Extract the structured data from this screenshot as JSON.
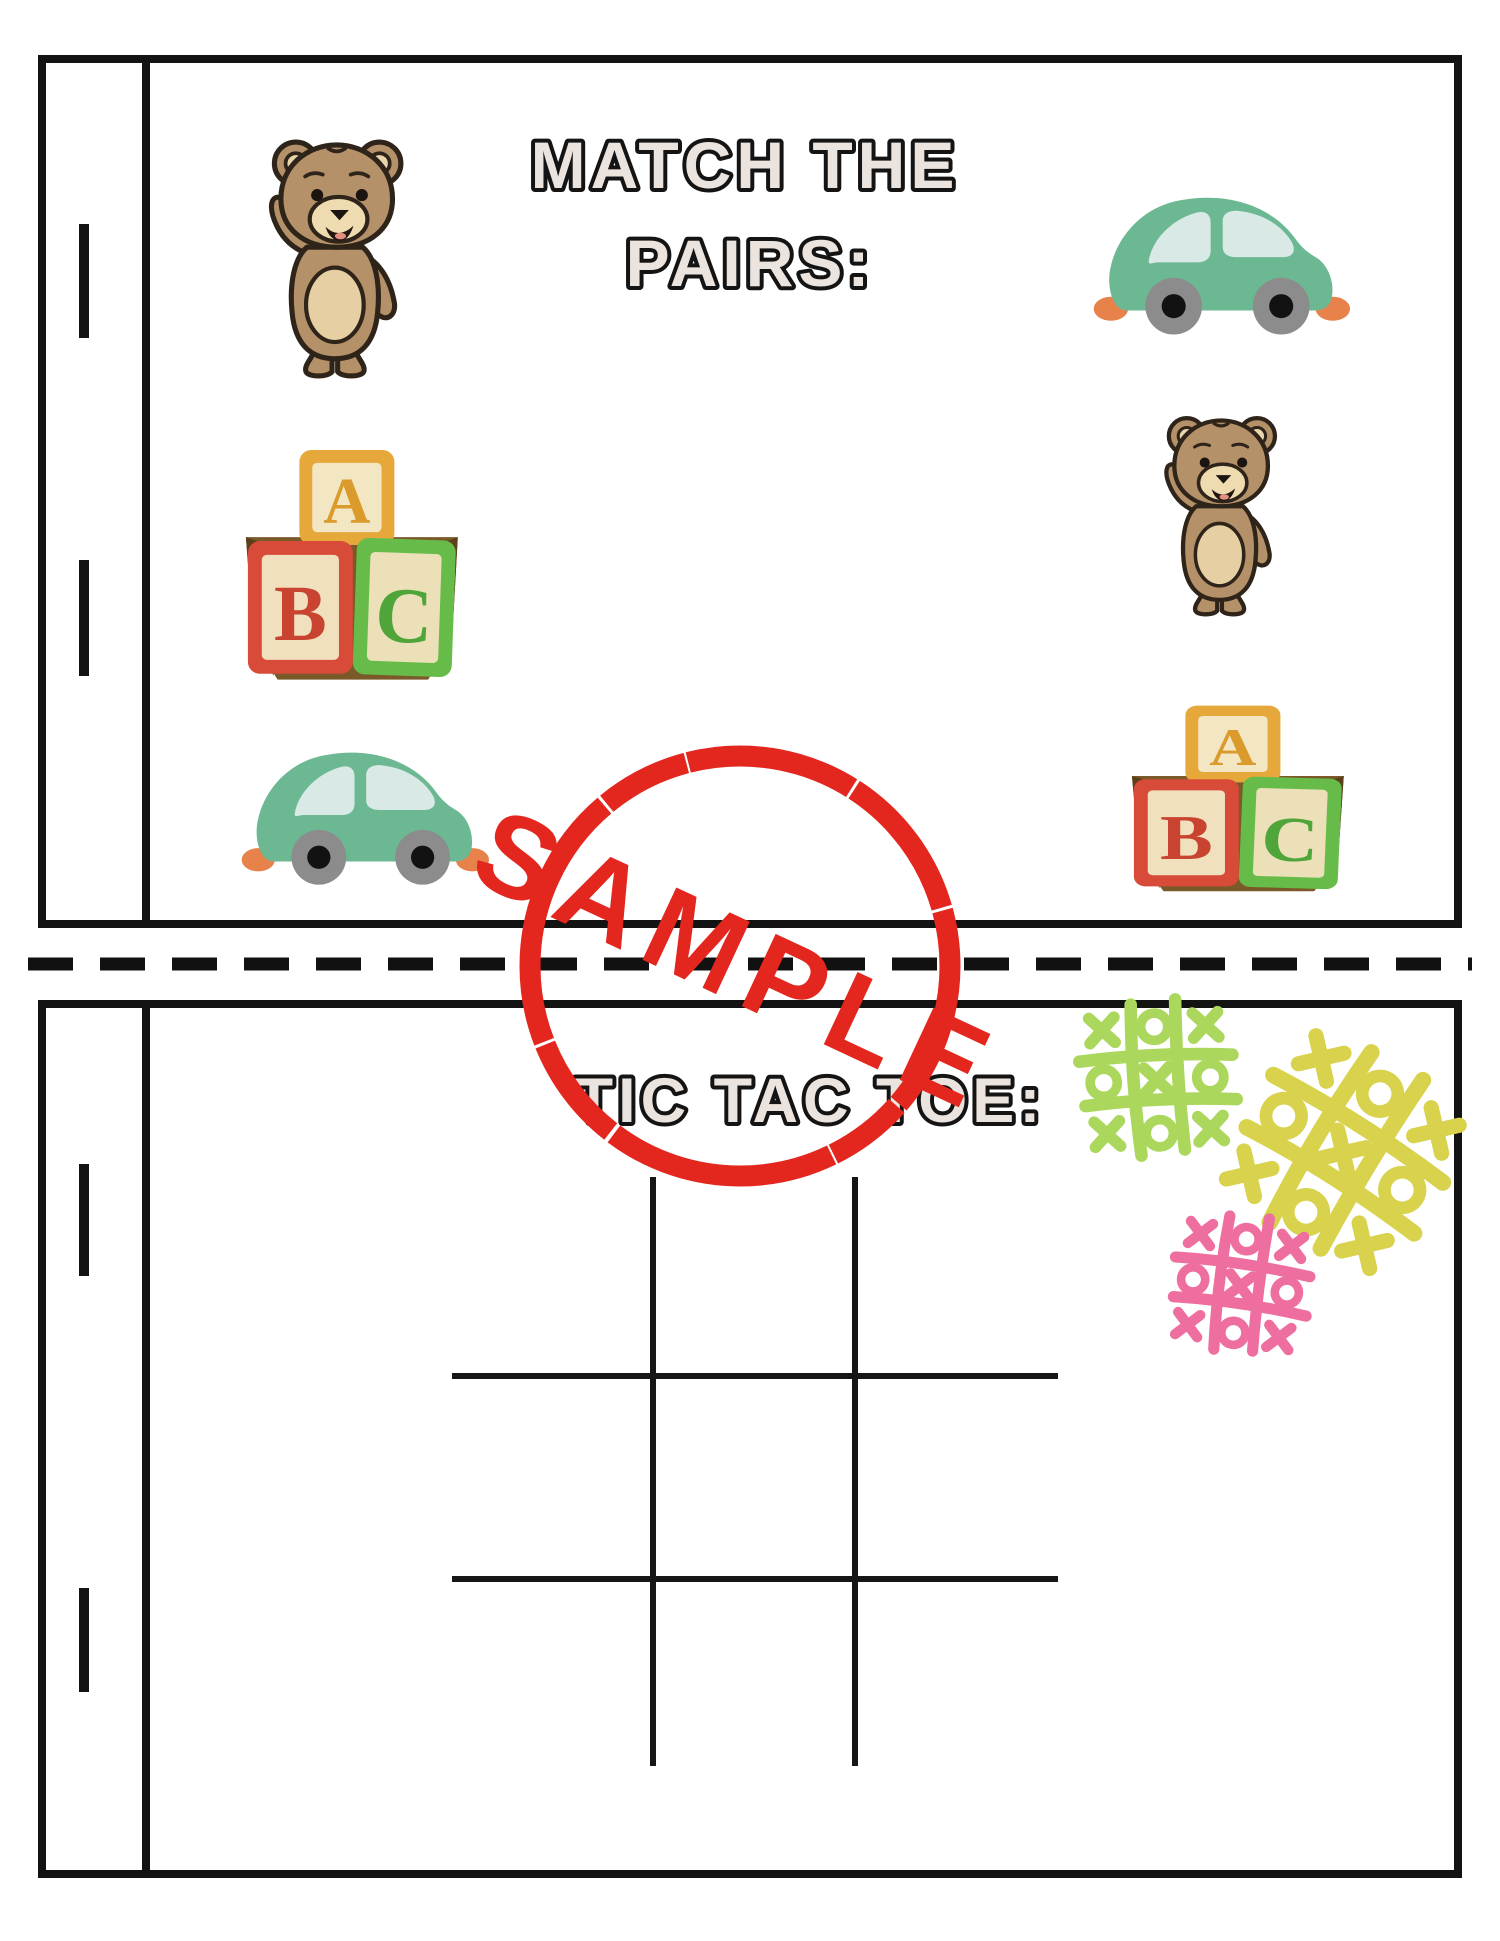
{
  "page": {
    "width_px": 1500,
    "height_px": 1941,
    "background": "#ffffff"
  },
  "top_panel": {
    "title_line1": "MATCH THE",
    "title_line2": "PAIRS:",
    "left_items": [
      "teddy-bear",
      "abc-blocks",
      "green-toy-car"
    ],
    "right_items": [
      "green-toy-car",
      "teddy-bear",
      "abc-blocks"
    ]
  },
  "bottom_panel": {
    "title": "TIC TAC TOE:",
    "grid": {
      "rows": 3,
      "cols": 3,
      "line_color": "#161616"
    },
    "doodles": [
      {
        "name": "tic-tac-toe-doodle-green",
        "color": "#abd75d",
        "pattern": [
          [
            "X",
            "O",
            "X"
          ],
          [
            "O",
            "X",
            "O"
          ],
          [
            "X",
            "O",
            "X"
          ]
        ]
      },
      {
        "name": "tic-tac-toe-doodle-yellow",
        "color": "#d8d24c",
        "pattern": [
          [
            "X",
            "O",
            "X"
          ],
          [
            "O",
            "X",
            "O"
          ],
          [
            "X",
            "O",
            "X"
          ]
        ]
      },
      {
        "name": "tic-tac-toe-doodle-pink",
        "color": "#ee6f9f",
        "pattern": [
          [
            "X",
            "O",
            "X"
          ],
          [
            "O",
            "X",
            "O"
          ],
          [
            "X",
            "O",
            "X"
          ]
        ]
      }
    ]
  },
  "watermark": {
    "label": "SAMPLE",
    "color": "#e3271f",
    "shape": "circle-stamp"
  },
  "blocks": {
    "letters": [
      "A",
      "B",
      "C"
    ]
  },
  "styles": {
    "title_fill": "#ebe3de",
    "title_outline": "#141414",
    "cut_line_color": "#111111",
    "panel_border_color": "#131313",
    "bear_fur": "#b5916a",
    "bear_muzzle": "#eedbb0",
    "car_body": "#6cb893",
    "car_window": "#d9e9e5",
    "car_wheel": "#8c8c8c",
    "car_bumper": "#e8824b",
    "block_a_border": "#e7a83b",
    "block_b_border": "#d84b38",
    "block_c_border": "#67bc49",
    "block_face": "#f2e6c3",
    "wood_brown": "#7a5a28"
  }
}
